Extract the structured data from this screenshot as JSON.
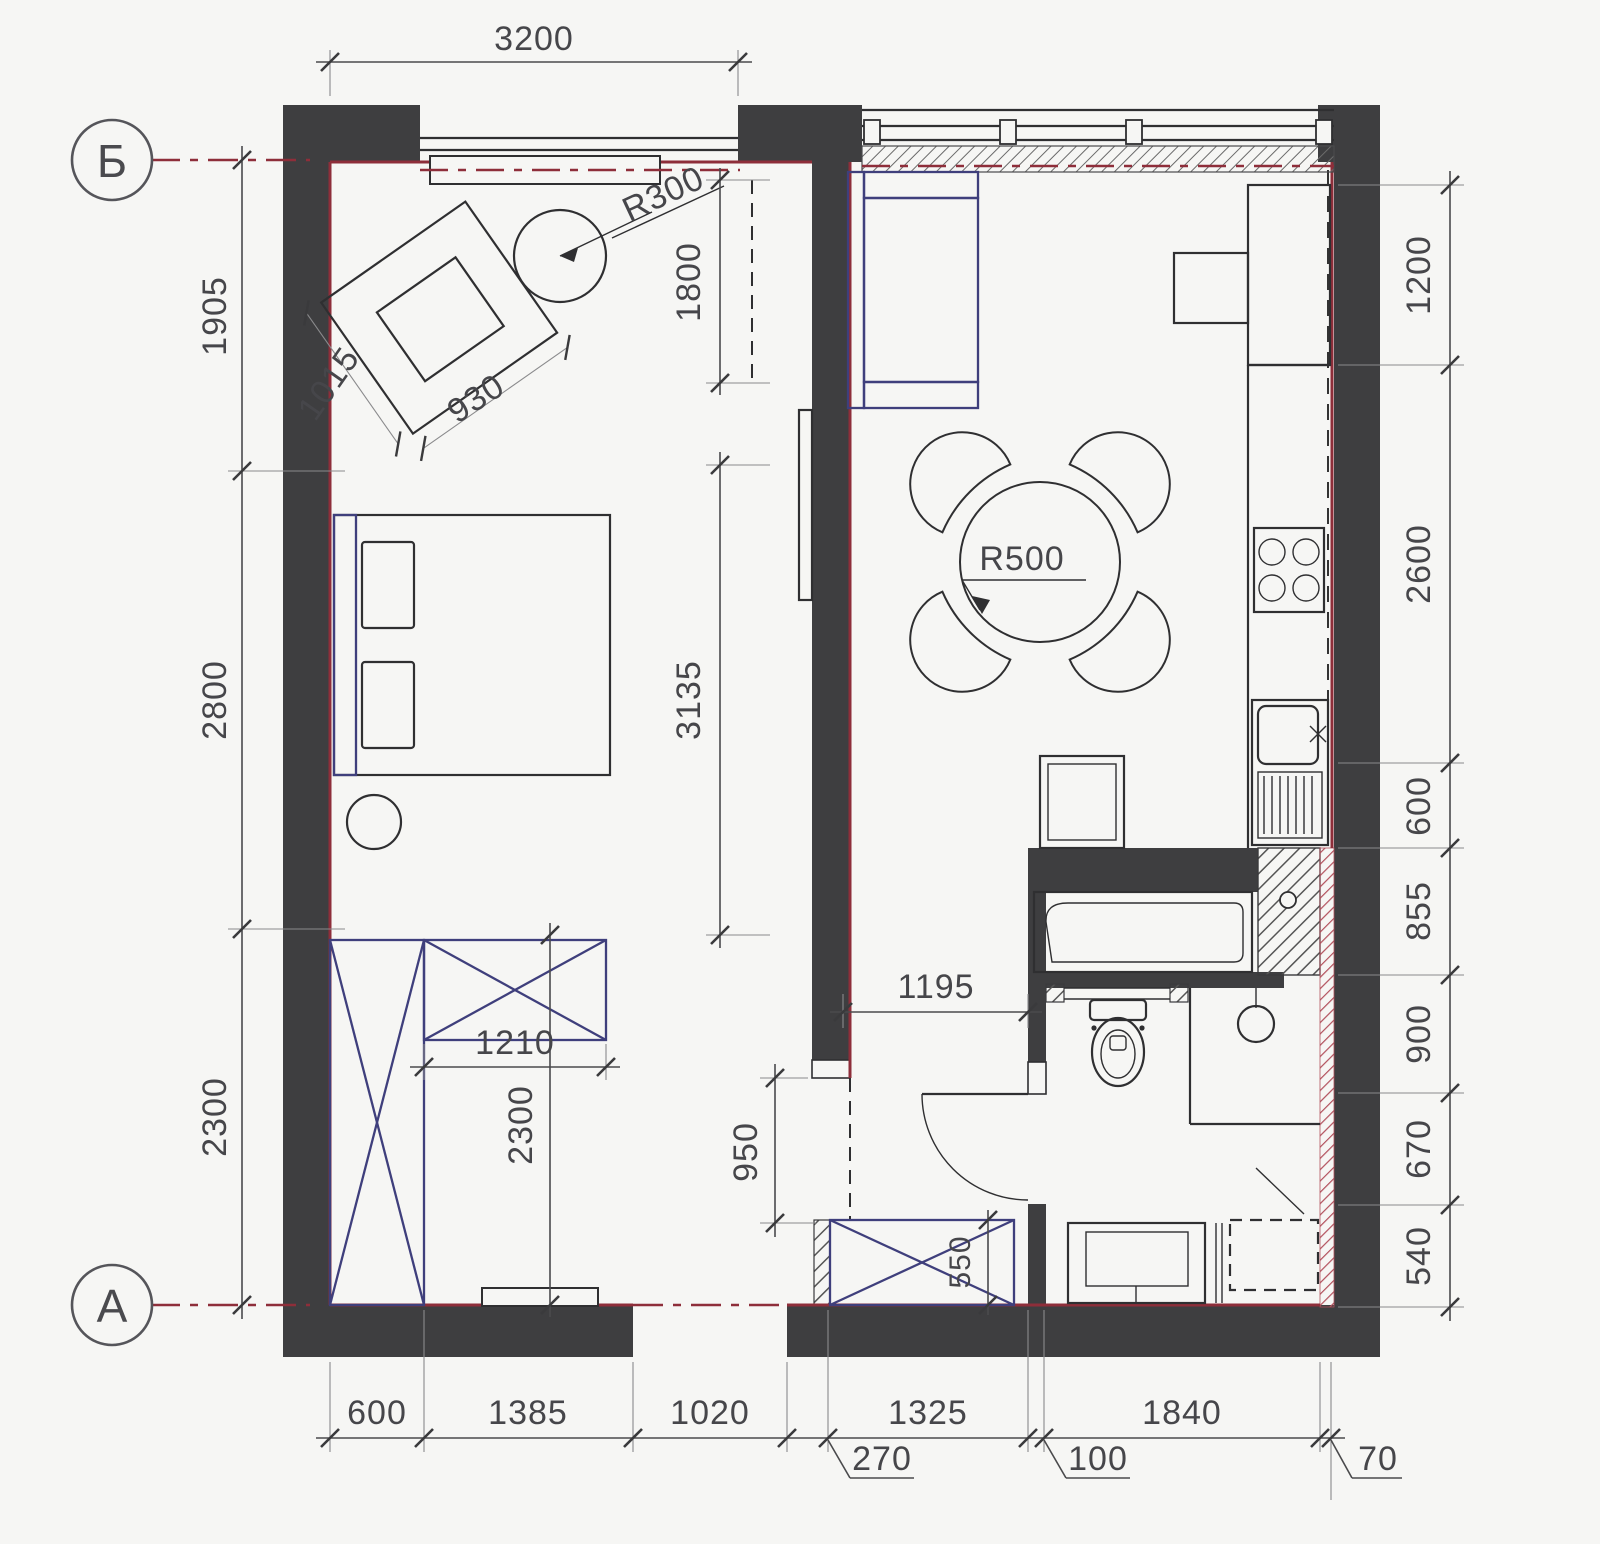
{
  "document": {
    "type": "floor-plan",
    "units": "mm",
    "background": "#f6f6f4"
  },
  "colors": {
    "wall": "#3e3e40",
    "outline": "#2f2f31",
    "furniture_accent": "#3f3f7c",
    "bearing_accent_red": "#8e2e3a",
    "dimension_text": "#46464a"
  },
  "grid_axes": {
    "top_left": "Б",
    "bottom_left": "А"
  },
  "dims": {
    "top": {
      "seg0": "3200"
    },
    "left": {
      "seg0": "1905",
      "seg1": "2800",
      "seg2": "2300"
    },
    "right": {
      "seg0": "1200",
      "seg1": "2600",
      "seg2": "600",
      "seg3": "855",
      "seg4": "900",
      "seg5": "670",
      "seg6": "540"
    },
    "bottom": {
      "seg0": "600",
      "seg1": "1385",
      "seg2": "1020",
      "seg3": "1325",
      "seg4": "1840",
      "leader0": "270",
      "leader1": "100",
      "leader2": "70"
    },
    "interior": {
      "armchair_side": "1015",
      "armchair_front": "930",
      "side_table_radius": "R300",
      "bedroom_niche": "1800",
      "bedroom_wall_run": "3135",
      "dining_table_radius": "R500",
      "dresser_width": "1210",
      "bedroom_depth": "2300",
      "hall_width": "1195",
      "hall_passage": "950",
      "hall_wardrobe_depth": "550"
    }
  }
}
